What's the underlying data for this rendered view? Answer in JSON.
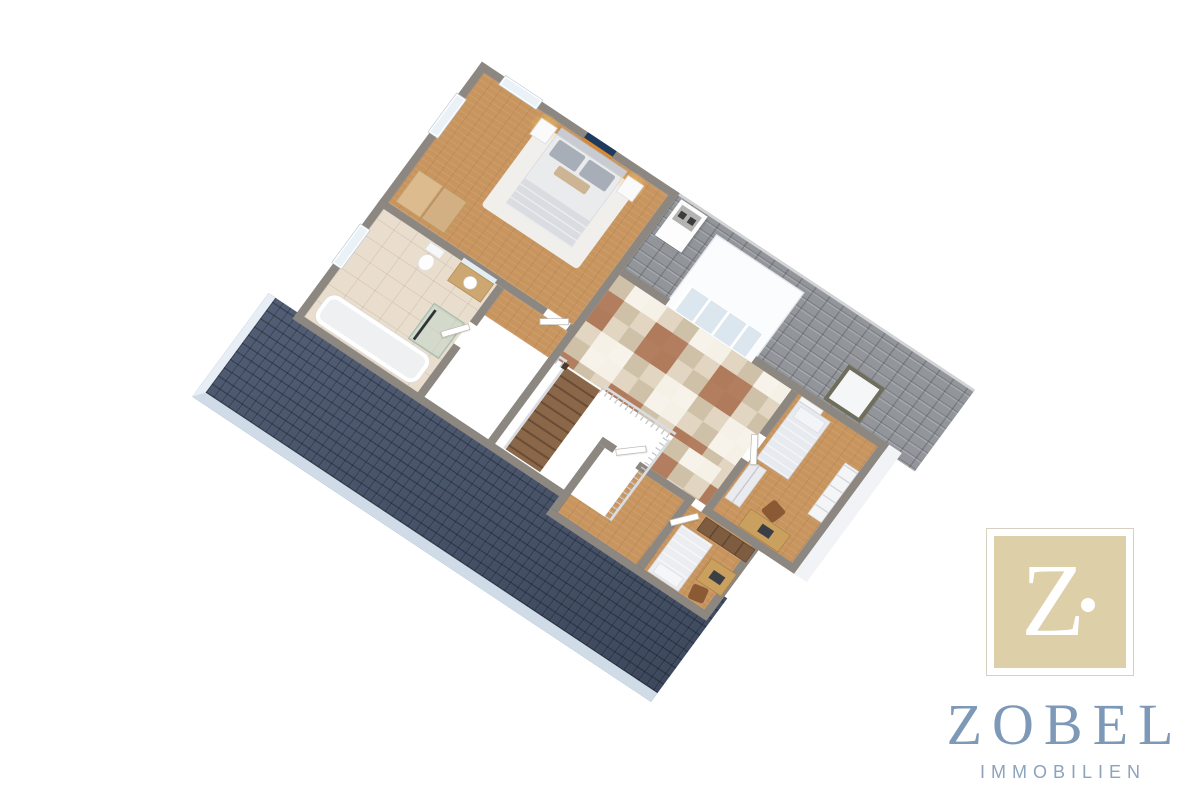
{
  "brand": {
    "monogram_letter": "Z",
    "name": "ZOBEL",
    "tagline": "IMMOBILIEN",
    "colors": {
      "monogram_bg": "#ddcfa8",
      "monogram_letter": "#ffffff",
      "frame": "#d6d0c0",
      "name_text": "#7d99b7",
      "tagline_text": "#8ba3bd"
    }
  },
  "floorplan": {
    "view": "3D isometric cutaway floor plan of an upper attic floor",
    "background": "#ffffff",
    "rooms": {
      "master_bedroom": "Bedroom with double bed, nightstands, lamps and wall art",
      "bathroom": "Bathroom with bathtub, shower, WC and washbasin",
      "hallway": "Tiled landing below glazed dormer",
      "stairwell": "Open stairwell with wooden staircase and balustrade",
      "bedroom_2": "Bedroom with single bed, wardrobe, shelving and desk",
      "bedroom_3": "Bedroom with bed, desk, chair and wardrobe",
      "storage_room": "Empty room with wood floor",
      "dormer": "Dormer with glazed front",
      "roof_front": "Front roof slope with dark slate tiles",
      "roof_rear": "Rear roof slope with gray tiles, skylight and chimney"
    },
    "colors": {
      "roof_front": "#47546c",
      "roof_rear": "#92969b",
      "walls": "#8d8781",
      "wood_floor": "#c8955f",
      "tile_floor": "#d9cab4",
      "tile_accent": "#ab6f4e",
      "bathroom_tile": "#e9ddcd",
      "eave": "#cfdce8"
    }
  }
}
